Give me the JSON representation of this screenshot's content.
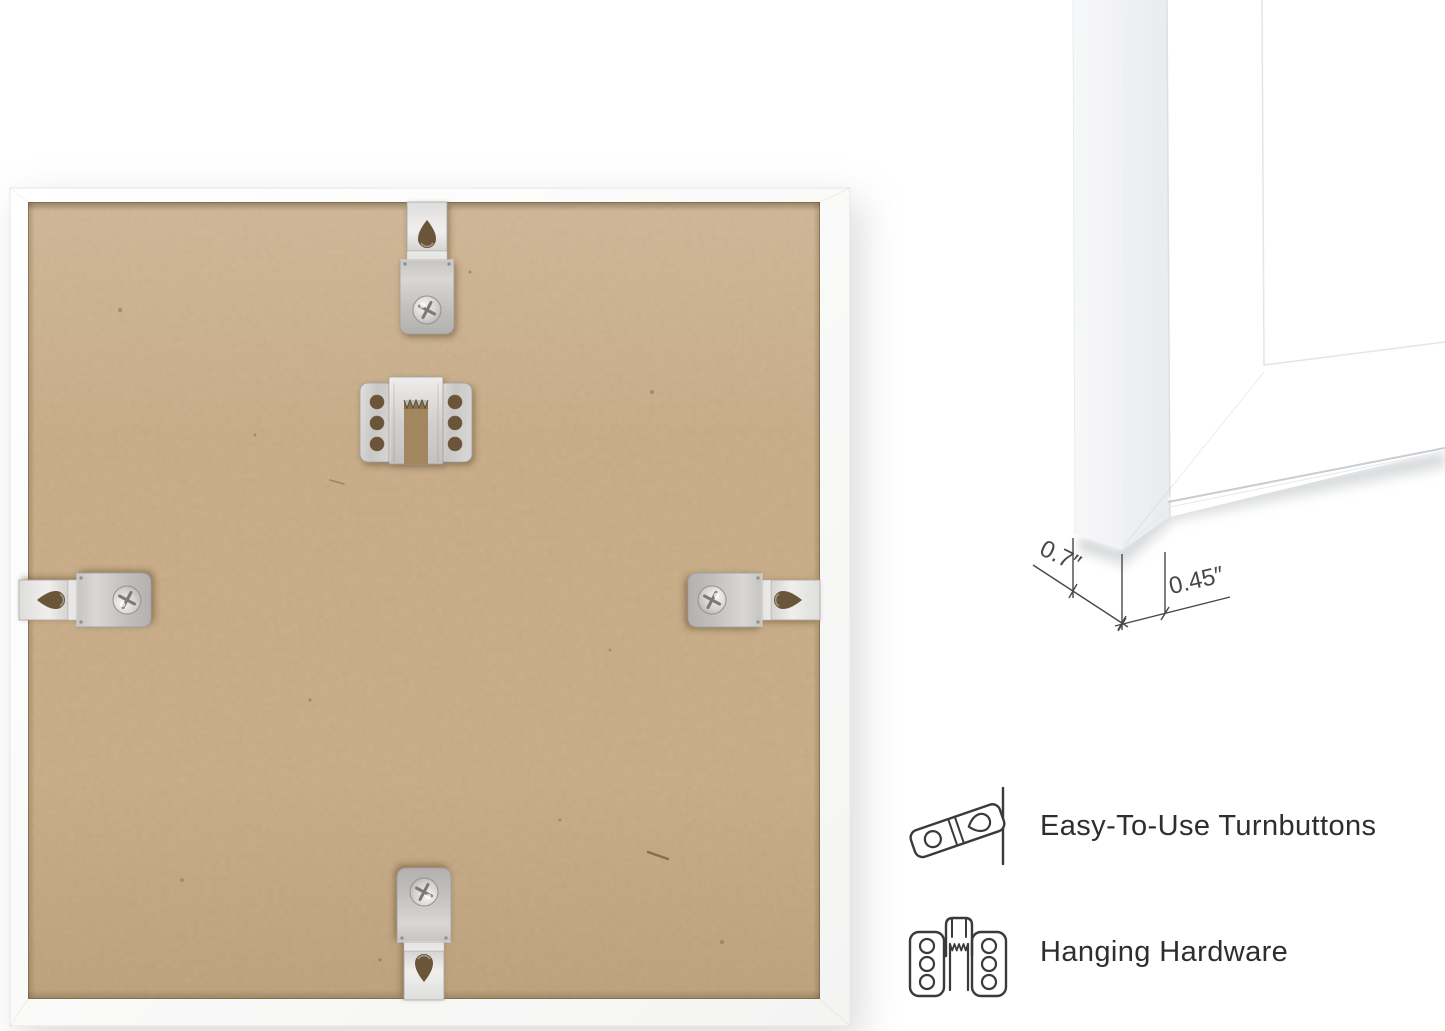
{
  "page": {
    "background_color": "#ffffff"
  },
  "back_view": {
    "name": "picture-frame-back-photo",
    "frame_color": "#fbfbfb",
    "mdf_board_color": "#c9ab83",
    "hardware": {
      "turnbuttons": [
        "top",
        "left",
        "right",
        "bottom"
      ],
      "hanger": "sawtooth-hanger"
    }
  },
  "corner_detail": {
    "depth_label": "0.7″",
    "face_width_label": "0.45″"
  },
  "features": [
    {
      "icon": "turnbutton-icon",
      "label": "Easy-To-Use Turnbuttons"
    },
    {
      "icon": "sawtooth-hanger-icon",
      "label": "Hanging Hardware"
    }
  ],
  "colors": {
    "mdf_board": "#c9ab83",
    "metal_hardware": "#cfcecc",
    "line_art": "#3a3a3a",
    "dimension_line": "#46484b"
  }
}
